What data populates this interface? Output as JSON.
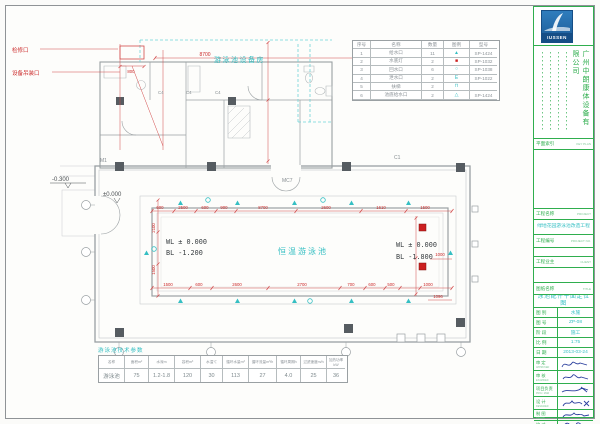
{
  "legend": {
    "headers": [
      "序号",
      "名称",
      "数量",
      "图例",
      "型号"
    ],
    "rows": [
      {
        "no": "1",
        "name": "给水口",
        "qty": "11",
        "icon": "▲",
        "model": "SP-1424"
      },
      {
        "no": "2",
        "name": "水底灯",
        "qty": "2",
        "icon": "■",
        "model": "SP-1032"
      },
      {
        "no": "3",
        "name": "回水口",
        "qty": "6",
        "icon": "○",
        "model": "SP-1038"
      },
      {
        "no": "4",
        "name": "泄水口",
        "qty": "2",
        "icon": "E",
        "model": "SP-1022"
      },
      {
        "no": "5",
        "name": "扶梯",
        "qty": "2",
        "icon": "⊓",
        "model": ""
      },
      {
        "no": "6",
        "name": "池底给水口",
        "qty": "2",
        "icon": "△",
        "model": "SP-1424"
      }
    ]
  },
  "params": {
    "title": "游泳池技术参数",
    "headers": [
      "名称",
      "面积m²",
      "水深m",
      "容积m³",
      "水温℃",
      "循环水量m³",
      "循环流量m³/h",
      "循环周期h",
      "过滤速度m/h",
      "加热功率kW"
    ],
    "values": [
      "游泳池",
      "75",
      "1.2-1.8",
      "120",
      "30",
      "113",
      "27",
      "4.0",
      "25",
      "36"
    ]
  },
  "plan": {
    "room_label": "游泳池设备房",
    "pool_label": "恒温游泳池",
    "wl_left": "WL ± 0.000",
    "bl_left": "BL -1.200",
    "wl_right": "WL ± 0.000",
    "bl_right": "BL -1.800",
    "level_a": "-0.300",
    "level_b": "±0.000",
    "ann_access": "检修口",
    "ann_hoist": "设备吊装口",
    "grid": {
      "m1": "M1",
      "mc7": "MC7",
      "c1": "C1",
      "c4": "C4"
    },
    "dims": {
      "top_long": "8700",
      "hoist": "800",
      "top": [
        "600",
        "2500",
        "600",
        "900",
        "8700",
        "2600",
        "1610",
        "1500"
      ],
      "bottom": [
        "1500",
        "600",
        "2600",
        "2700",
        "700",
        "600",
        "500",
        "1000"
      ],
      "left": [
        "2100",
        "1500"
      ],
      "right": [
        "1000",
        "1096"
      ]
    }
  },
  "titleblock": {
    "logo_text": "IUSSEN",
    "company": "广州中朗康体设备有限公司",
    "key_plan_cn": "平面索引",
    "key_plan_en": "KEY PLAN",
    "project_cn": "工程名称",
    "project_en": "PROJECT",
    "project_name": "绿地花园游泳池改造工程",
    "project_no_cn": "工程编号",
    "project_no_en": "PROJECT NO.",
    "client_cn": "工程业主",
    "client_en": "CLIENT",
    "title_cn": "图纸名称",
    "title_en": "TITLE",
    "drawing_title": "泳池配件平面定位图",
    "fields": [
      {
        "label": "图 别",
        "value": "水施"
      },
      {
        "label": "图 号",
        "value": "ZP-08"
      },
      {
        "label": "阶 段",
        "value": "施工"
      },
      {
        "label": "比 例",
        "value": "1:75"
      },
      {
        "label": "日 期",
        "value": "2013-03-24"
      }
    ],
    "signs": [
      {
        "label": "审 定",
        "en": "APPROVED"
      },
      {
        "label": "审 核",
        "en": "EXAMINED"
      },
      {
        "label": "项目负责",
        "en": "PROJ. MGR"
      },
      {
        "label": "设 计",
        "en": "DESIGNED"
      },
      {
        "label": "制 图",
        "en": "DRAWN"
      },
      {
        "label": "校 对",
        "en": "CHECKED"
      },
      {
        "label": "会 签",
        "en": "SIGNATURE"
      }
    ]
  }
}
